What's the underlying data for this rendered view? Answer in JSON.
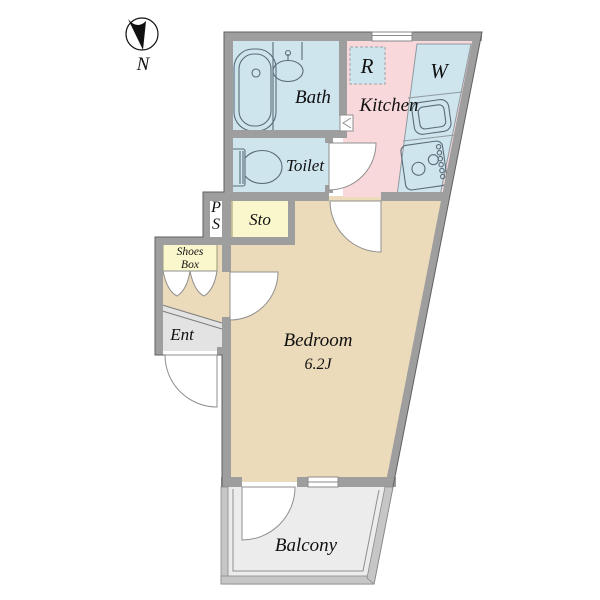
{
  "title": "Apartment floor plan",
  "compass": {
    "north_label": "N"
  },
  "rooms": {
    "bath": {
      "label": "Bath"
    },
    "kitchen": {
      "label": "Kitchen"
    },
    "toilet": {
      "label": "Toilet"
    },
    "refrigerator_space": {
      "label": "R"
    },
    "washer_space": {
      "label": "W"
    },
    "pipe_space": {
      "line1": "P",
      "line2": "S"
    },
    "storage": {
      "label": "Sto"
    },
    "shoes_box": {
      "line1": "Shoes",
      "line2": "Box"
    },
    "entrance": {
      "label": "Ent"
    },
    "bedroom": {
      "label": "Bedroom",
      "size": "6.2J"
    },
    "balcony": {
      "label": "Balcony"
    }
  },
  "colors": {
    "room_blue": "#cfe5ee",
    "kitchen_pink": "#f9d8db",
    "storage_yellow": "#fbf7cd",
    "bedroom_tan": "#ecdbbb",
    "entrance_gray": "#e3e3e3",
    "balcony_gray": "#ececec",
    "wall_gray": "#9e9e9e",
    "rail_gray": "#c6c6c6",
    "ps_white": "#ffffff"
  }
}
